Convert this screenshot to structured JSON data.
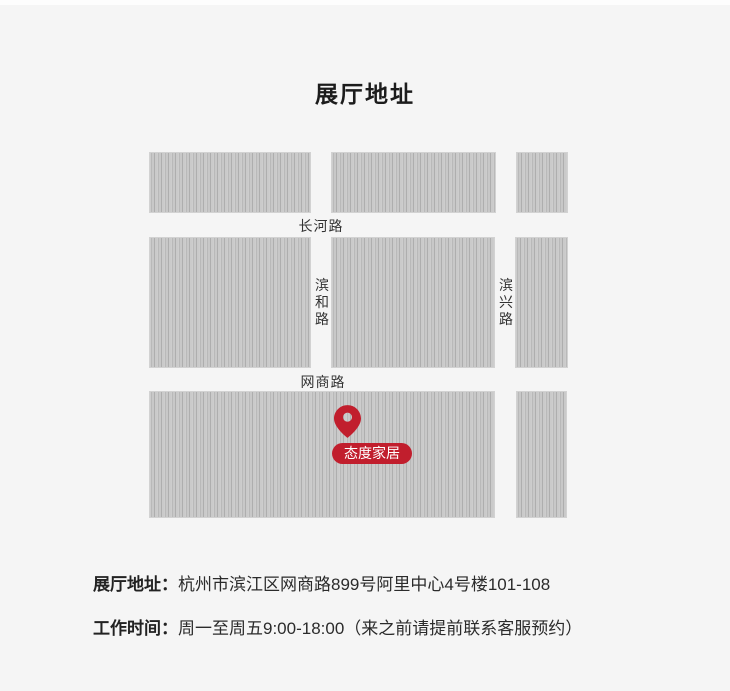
{
  "page": {
    "title": "展厅地址",
    "background": "#f5f5f5"
  },
  "theme": {
    "accent": "#c11e2d",
    "block_fill": "#c3c3c3",
    "text": "#2b2b2b"
  },
  "map": {
    "roads": {
      "changhe": "长河路",
      "binhe": "滨和路",
      "binxing": "滨兴路",
      "wangshang": "网商路"
    },
    "marker": {
      "label": "态度家居",
      "icon": "location-pin-icon",
      "color": "#c11e2d"
    }
  },
  "info": {
    "address_label": "展厅地址：",
    "address_value": "杭州市滨江区网商路899号阿里中心4号楼101-108",
    "hours_label": "工作时间：",
    "hours_value": "周一至周五9:00-18:00（来之前请提前联系客服预约）"
  }
}
